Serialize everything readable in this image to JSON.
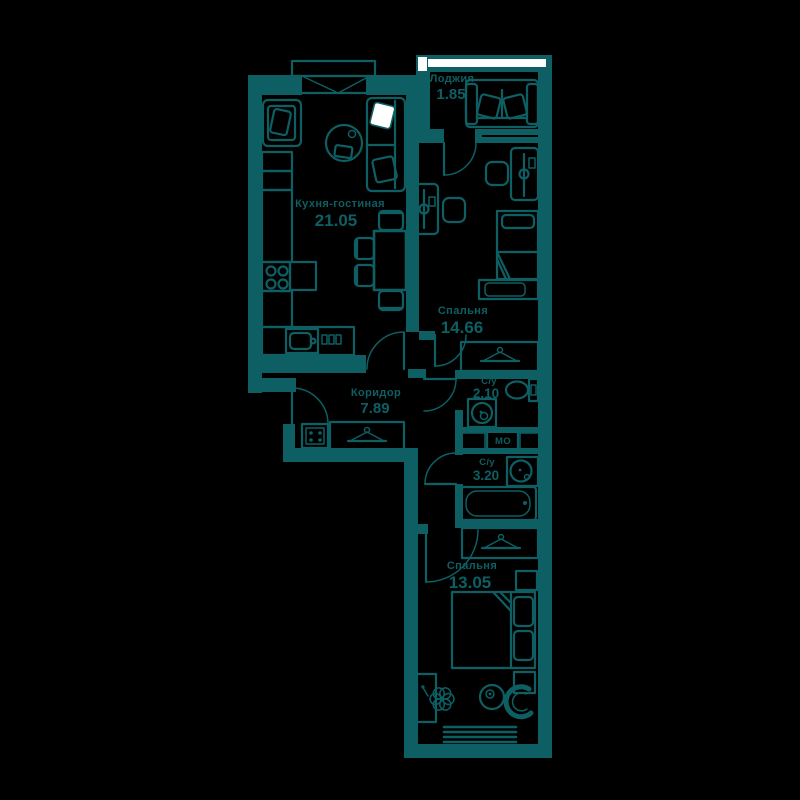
{
  "plan": {
    "colors": {
      "line": "#0d5f63",
      "background": "#000000",
      "window": "#ffffff"
    },
    "rooms": [
      {
        "id": "loggia",
        "name": "Лоджия",
        "area": "1.85"
      },
      {
        "id": "kitchen-living",
        "name": "Кухня-гостиная",
        "area": "21.05"
      },
      {
        "id": "bedroom-1",
        "name": "Спальня",
        "area": "14.66"
      },
      {
        "id": "corridor",
        "name": "Коридор",
        "area": "7.89"
      },
      {
        "id": "bathroom-1",
        "name": "С/у",
        "area": "2.10"
      },
      {
        "id": "bathroom-2",
        "name": "С/у",
        "area": "3.20"
      },
      {
        "id": "bedroom-2",
        "name": "Спальня",
        "area": "13.05"
      }
    ],
    "labels": {
      "washing_machine_niche": "МО"
    }
  }
}
